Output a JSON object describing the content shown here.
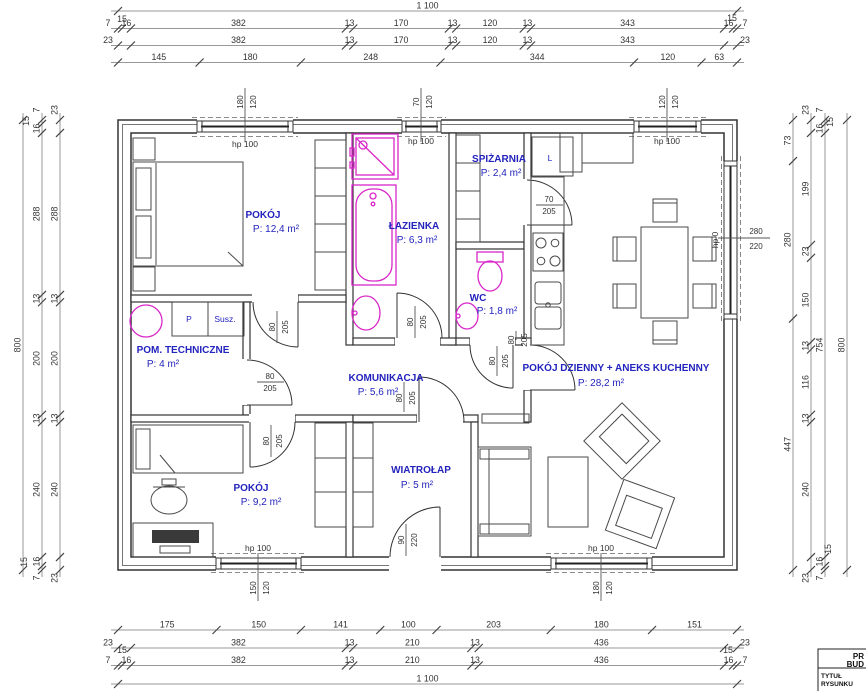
{
  "dims": {
    "off15": "15",
    "top": {
      "row1": [
        "1 100"
      ],
      "row2": [
        "7",
        "16",
        "382",
        "13",
        "170",
        "13",
        "120",
        "13",
        "343",
        "16",
        "7"
      ],
      "row3": [
        "23",
        "382",
        "13",
        "170",
        "13",
        "120",
        "13",
        "343",
        "23"
      ],
      "row4": [
        "145",
        "180",
        "248",
        "344",
        "120",
        "63"
      ]
    },
    "bottom": {
      "rowA": [
        "175",
        "150",
        "141",
        "100",
        "203",
        "180",
        "151"
      ],
      "rowB": [
        "23",
        "382",
        "13",
        "210",
        "13",
        "436",
        "23"
      ],
      "rowC": [
        "7",
        "16",
        "382",
        "13",
        "210",
        "13",
        "436",
        "16",
        "7"
      ],
      "rowD": [
        "1 100"
      ]
    },
    "left": {
      "outer": [
        "800"
      ],
      "mid": [
        "7",
        "16",
        "288",
        "13",
        "200",
        "13",
        "240",
        "16",
        "7"
      ],
      "inner": [
        "23",
        "288",
        "13",
        "200",
        "13",
        "240",
        "23"
      ]
    },
    "right": {
      "inner": [
        "73",
        "280",
        "447"
      ],
      "mid": [
        "23",
        "199",
        "23",
        "150",
        "13",
        "116",
        "13",
        "240",
        "23"
      ],
      "c3": [
        "7",
        "16",
        "754",
        "16",
        "7"
      ],
      "outer": [
        "800"
      ]
    }
  },
  "floor_plan": {
    "rooms": [
      {
        "name": "POKÓJ",
        "area": "P: 12,4 m²"
      },
      {
        "name": "ŁAZIENKA",
        "area": "P: 6,3 m²"
      },
      {
        "name": "SPIŻARNIA",
        "area": "P: 2,4 m²"
      },
      {
        "name": "WC",
        "area": "P: 1,8 m²"
      },
      {
        "name": "POM. TECHNICZNE",
        "area": "P: 4 m²"
      },
      {
        "name": "KOMUNIKACJA",
        "area": "P: 5,6 m²"
      },
      {
        "name": "POKÓJ DZIENNY + ANEKS KUCHENNY",
        "area": "P: 28,2 m²"
      },
      {
        "name": "POKÓJ",
        "area": "P: 9,2 m²"
      },
      {
        "name": "WIATROŁAP",
        "area": "P: 5 m²"
      }
    ],
    "appliances": {
      "washer": "P",
      "dryer": "Susz.",
      "fridge": "L"
    },
    "windows": [
      {
        "w": "180",
        "h": "120",
        "sill": "hp 100"
      },
      {
        "w": "70",
        "h": "120",
        "sill": "hp 100"
      },
      {
        "w": "120",
        "h": "120",
        "sill": "hp 100"
      },
      {
        "w": "280",
        "h": "220",
        "sill": "hp 0"
      },
      {
        "w": "150",
        "h": "120",
        "sill": "hp 100"
      },
      {
        "w": "180",
        "h": "120",
        "sill": "hp 100"
      }
    ],
    "doors": [
      {
        "w": "80",
        "h": "205"
      },
      {
        "w": "80",
        "h": "205"
      },
      {
        "w": "80",
        "h": "205"
      },
      {
        "w": "80",
        "h": "205"
      },
      {
        "w": "70",
        "h": "205"
      },
      {
        "w": "80",
        "h": "205"
      },
      {
        "w": "80",
        "h": "205"
      },
      {
        "w": "90",
        "h": "220"
      },
      {
        "w": "80",
        "h": "205"
      }
    ],
    "colors": {
      "accent_blue": "#2323bd",
      "fixture_magenta": "#d926c9"
    }
  },
  "title_block": {
    "line1": "PR",
    "line2": "BUD",
    "row1": "TYTUŁ",
    "row2": "RYSUNKU"
  }
}
